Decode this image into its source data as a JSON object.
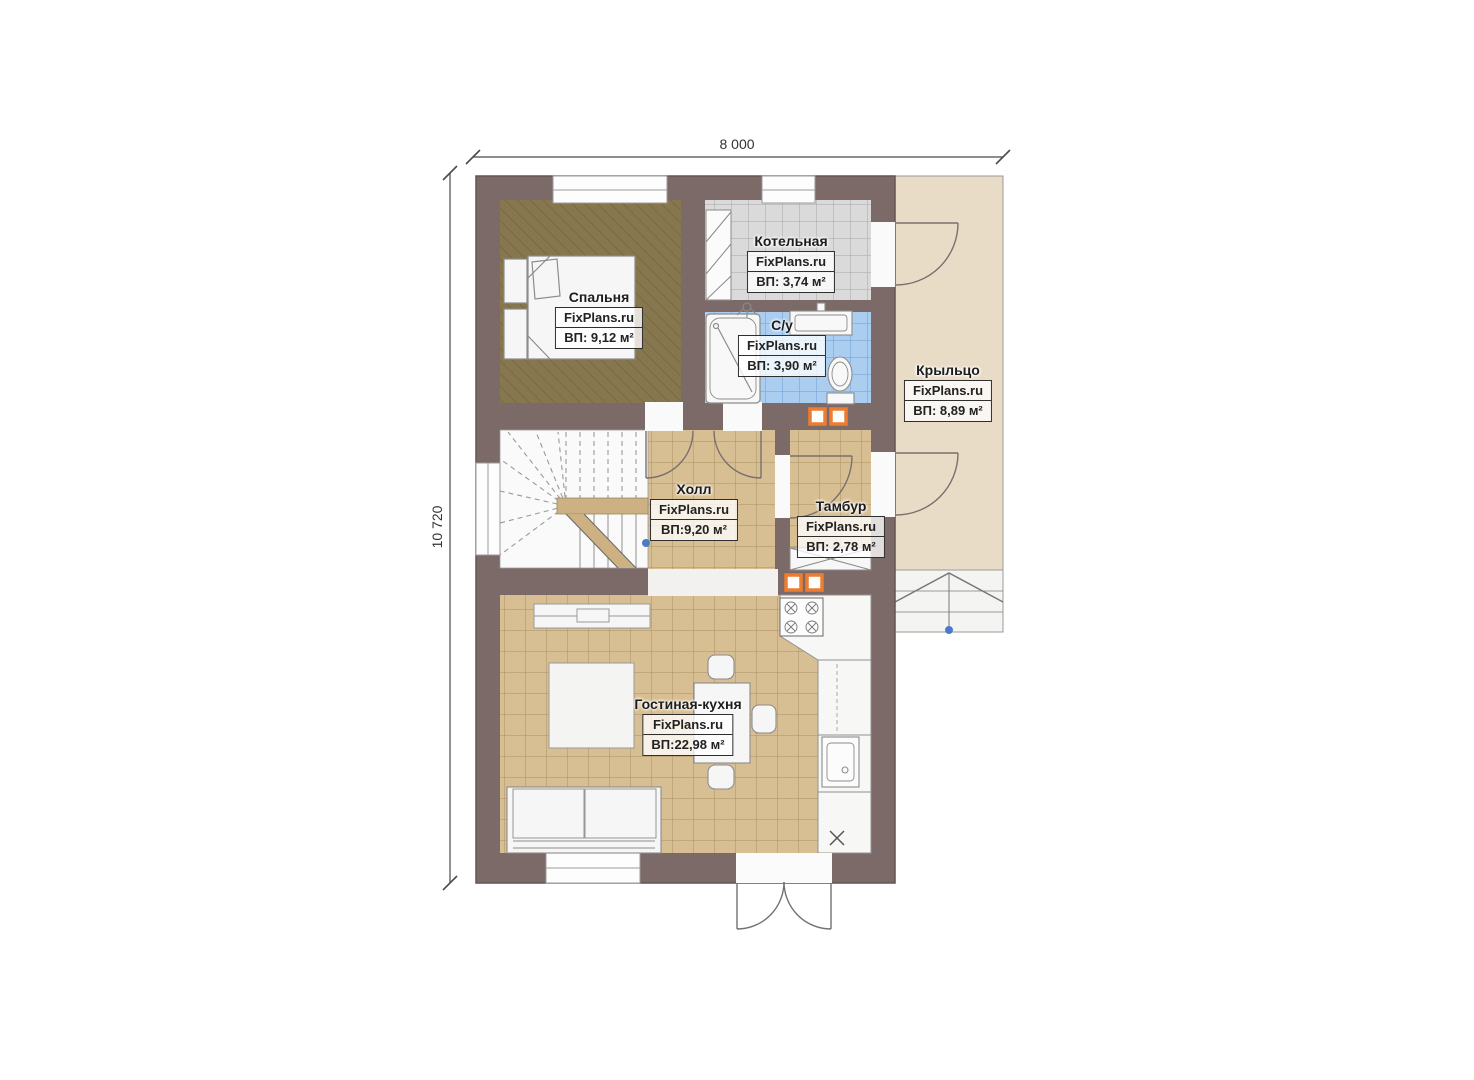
{
  "plan": {
    "watermark": "FixPlans.ru",
    "dimensions": {
      "top": "8 000",
      "left": "10 720"
    },
    "rooms": [
      {
        "name": "Спальня",
        "area": "ВП: 9,12 м²"
      },
      {
        "name": "Котельная",
        "area": "ВП: 3,74 м²"
      },
      {
        "name": "С/у",
        "area": "ВП: 3,90 м²"
      },
      {
        "name": "Крыльцо",
        "area": "ВП: 8,89 м²"
      },
      {
        "name": "Холл",
        "area": "ВП:9,20 м²"
      },
      {
        "name": "Тамбур",
        "area": "ВП: 2,78 м²"
      },
      {
        "name": "Гостиная-кухня",
        "area": "ВП:22,98 м²"
      }
    ],
    "colors": {
      "wall": "#7c6a68",
      "bedroom_floor": "#87774f",
      "tile_tan": "#d8bf93",
      "tile_gray": "#dadada",
      "tile_blue": "#aacdf0",
      "porch": "#e9dcc6",
      "accent_orange": "#ed7d31",
      "marker_blue": "#4a7bc8"
    }
  }
}
